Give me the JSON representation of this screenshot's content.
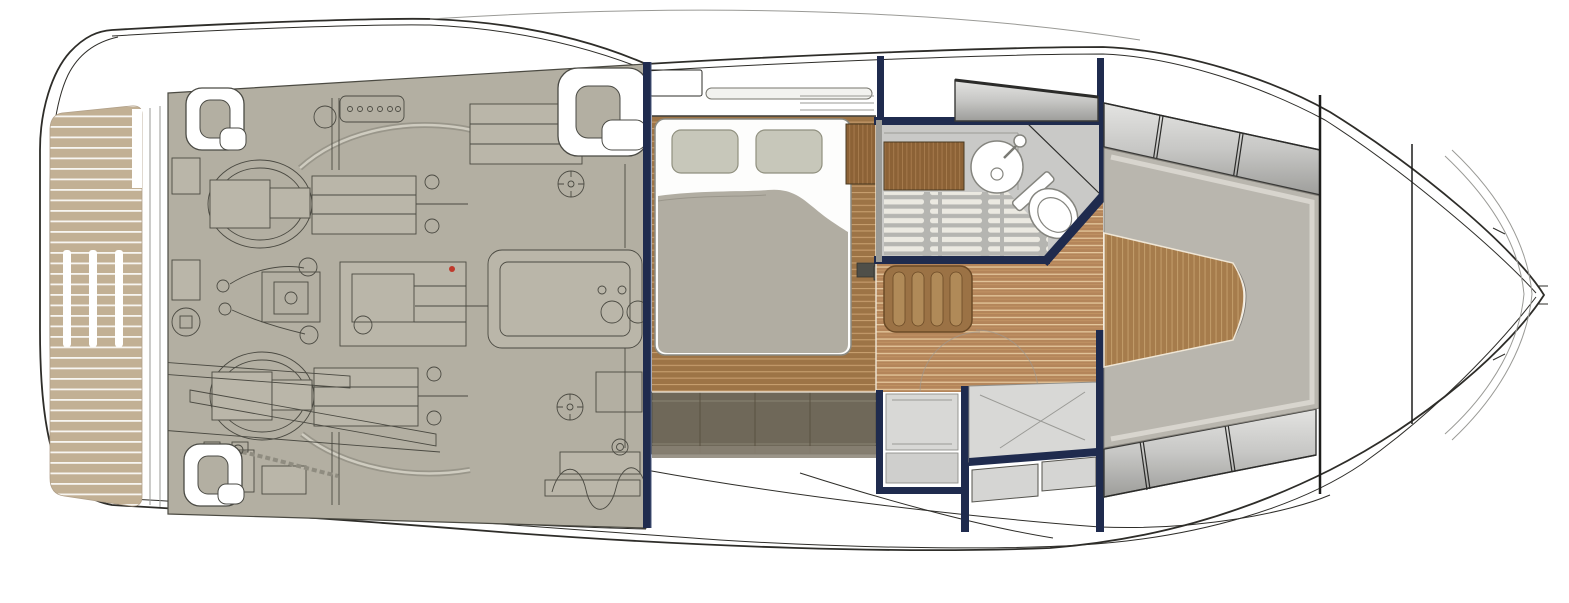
{
  "page": {
    "title": "Yacht lower-deck floor plan",
    "view": "top-down technical drawing, bow to the right, no visible text labels"
  },
  "colors": {
    "background": "#ffffff",
    "hull-line": "#2e2d29",
    "faint-line": "#9a9a96",
    "navy": "#1f2b4e",
    "engine-room": "#b3afa2",
    "machinery-line": "#4b4a42",
    "machinery-fill": "#bab6a9",
    "platform-teak": "#c2b094",
    "platform-stripe": "#f7f5f0",
    "saloon-teak": "#b4855a",
    "saloon-stripe": "#e4c79c",
    "vberth-teak": "#a67c4c",
    "vberth-grain": "#c09a68",
    "aft-floor-teak": "#9d7446",
    "aft-floor-stripe": "#c79e6e",
    "duvet": "#b1ada2",
    "pillow": "#c7c7ba",
    "mattress": "#fdfdfc",
    "cushion": "#b9b6ae",
    "cushion-bevel": "#dbd8d2",
    "window-panel": "#d2d2d0",
    "window-panel-dark": "#a2a29f",
    "locker-dark": "#6f6859",
    "locker-seam": "#8a8374",
    "bathroom-floor": "#c9c9c7",
    "shower-slat": "#ebe9e1",
    "shower-base": "#b5b5b1",
    "counter-teak": "#8c6236",
    "fixture-line": "#85857f",
    "galley-panel": "#d8d8d6",
    "step-dark": "#55544e",
    "table-teak": "#9b7245",
    "accent-red": "#c0392b"
  },
  "areas": {
    "swim_platform": {
      "label": "Aft swim platform with teak decking",
      "stripe_count": 38,
      "hatch_slots": 3
    },
    "engine_room": {
      "label": "Engine room with twin engines and systems",
      "engines": 2,
      "mooring_cleats": 3
    },
    "aft_cabin": {
      "label": "Aft cabin with double berth",
      "pillows": 2,
      "wardrobe": 1,
      "hull_lockers": true
    },
    "bathroom": {
      "label": "Head with round basin, toilet and teak shower grating",
      "sink": 1,
      "toilet": 1
    },
    "saloon": {
      "label": "Midship lobby with teak sole and folding table",
      "companionway_steps": 2
    },
    "galley": {
      "label": "Galley counter with stowage drawers",
      "drawers": 2
    },
    "bow_cabin": {
      "label": "Forward V-berth cabin with wrap-around cushions",
      "hull_window_panels_per_side": 3
    },
    "foredeck": {
      "label": "Foredeck with collision bulkheads and anchor locker",
      "bulkheads": 2
    }
  }
}
